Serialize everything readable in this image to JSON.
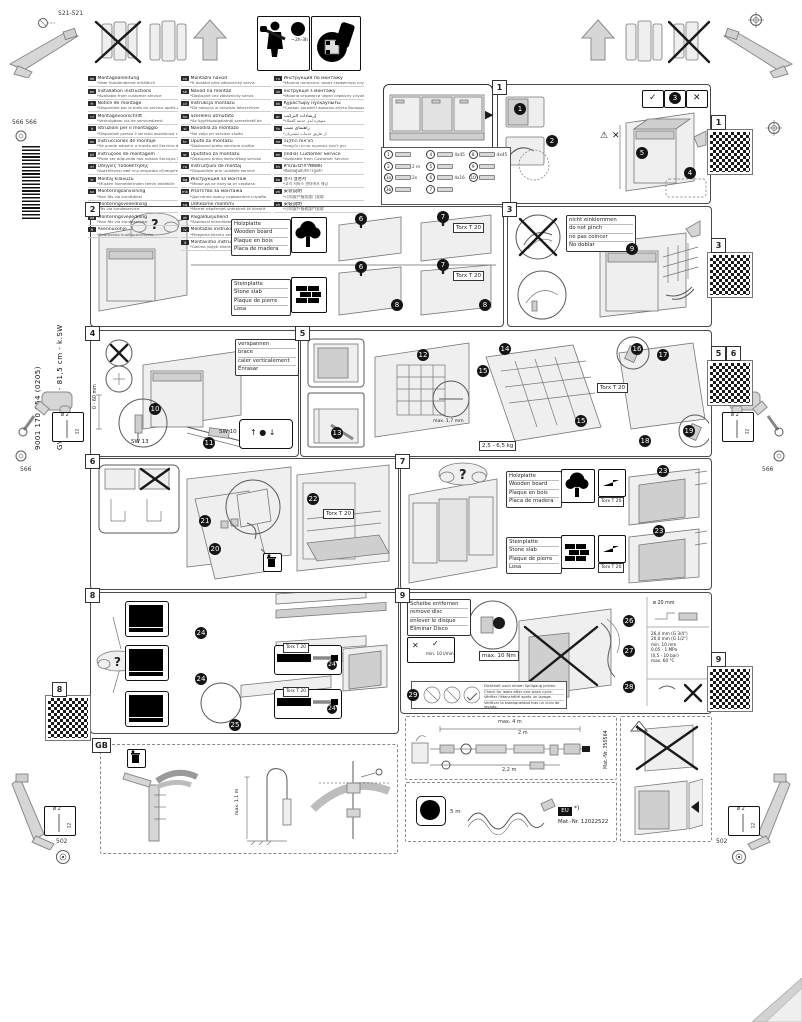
{
  "sidebar": {
    "doc_number": "9001 170 054 (0205)",
    "model": "GV 640 B Vol-I - 81,5 cm - k.SW"
  },
  "header": {
    "time": "~2h-3h"
  },
  "icons": {
    "check": "✓",
    "cross": "✕",
    "question": "?",
    "warning": "⚠",
    "arrow_right": "▶",
    "arrow_left": "◀",
    "balance": "↑ ● ↓"
  },
  "corner": {
    "dim_top_left": "521-521",
    "dim_left": "566 566",
    "dim_side": "566",
    "dim_bottom": "502",
    "drill_dia": "ø 2",
    "drill_depth": "12"
  },
  "panel_numbers": {
    "p1": "1",
    "p2": "2",
    "p3": "3",
    "p4": "4",
    "p5": "5",
    "p6": "6",
    "p7": "7",
    "p8": "8",
    "p9": "9",
    "gb": "GB"
  },
  "qr": {
    "q1": "1",
    "q3": "3",
    "q5": "5",
    "q6": "6",
    "q8": "8",
    "q9": "9"
  },
  "steps": {
    "n1": "1",
    "n2": "2",
    "n3": "3",
    "n4": "4",
    "n5": "5",
    "n6": "6",
    "n7": "7",
    "n8": "8",
    "n9": "9",
    "n10": "10",
    "n11": "11",
    "n12": "12",
    "n13": "13",
    "n14": "14",
    "n15": "15",
    "n16": "16",
    "n17": "17",
    "n18": "18",
    "n19": "19",
    "n20": "20",
    "n21": "21",
    "n22": "22",
    "n23": "23",
    "n24": "24",
    "n25": "25",
    "n26": "26",
    "n27": "27",
    "n28": "28",
    "n29": "29"
  },
  "labels": {
    "wood": [
      "Holzplatte",
      "Wooden board",
      "Plaque en bois",
      "Placa de madera"
    ],
    "stone": [
      "Steinplatte",
      "Stone slab",
      "Plaque de pierre",
      "Losa"
    ],
    "pinch": [
      "nicht einklemmen",
      "do not pinch",
      "ne pas coincer",
      "No doblar"
    ],
    "brace": [
      "verspannen",
      "brace",
      "caler verticalement",
      "Enrasar"
    ],
    "disc": [
      "Scheibe entfernen",
      "remove disc",
      "enlever le disque",
      "Eliminar Disco"
    ],
    "leak": [
      "Dichtheit nach einem Spülgang prüfen.",
      "Check for leaks after one wash cycle.",
      "Vérifier l'étanchéité après un lavage.",
      "Verificar la estanqueidad tras un ciclo de lavado."
    ],
    "torx": "Torx T 20",
    "sw13": "SW 13",
    "sw10": "SW 10",
    "feet_range": "0 - 60 mm",
    "gap": "max. 1,7 mm",
    "panel_weight": "2,5 - 6,5 kg",
    "torque": "max. 10 Nm",
    "flow": "min. 10 l/min",
    "drain_dia": "ø 20 mm",
    "thread1": "26,4 mm (G 3/4\")",
    "thread2": "20,0 mm (G 1/2\")",
    "clearance": "min. 10 mm",
    "pressure1": "0,05 - 1 MPa",
    "pressure2": "(0,5 - 10 bar)",
    "temp": "max. 60 °C",
    "standpipe": "max. 1,1 m",
    "hose_total": "max. 4 m",
    "hose_a": "2 m",
    "hose_b": "2,2 m",
    "hose_part": "Mat.-Nr. 350564",
    "cord_len": "5 m",
    "region": "EU",
    "asterisk": "*)",
    "cord_part": "Mat.-Nr. 12022522"
  },
  "parts": [
    {
      "no": "1",
      "label": ""
    },
    {
      "no": "2",
      "label": "2 m"
    },
    {
      "no": "3a",
      "label": "2x"
    },
    {
      "no": "3b",
      "label": ""
    },
    {
      "no": "4",
      "label": "4x45"
    },
    {
      "no": "5",
      "label": ""
    },
    {
      "no": "6",
      "label": "4x16"
    },
    {
      "no": "7",
      "label": ""
    },
    {
      "no": "8",
      "label": "4x45"
    },
    {
      "no": "9",
      "label": ""
    },
    {
      "no": "10",
      "label": ""
    }
  ],
  "languages": {
    "col1": [
      {
        "c": "de",
        "t": "Montageanleitung",
        "n": "*über Kundendienst erhältlich"
      },
      {
        "c": "en",
        "t": "Installation instructions",
        "n": "*Available from customer service"
      },
      {
        "c": "fr",
        "t": "Notice de montage",
        "n": "*Disponible par le biais du service après-vente"
      },
      {
        "c": "nl",
        "t": "Montagevoorschrift",
        "n": "*Verkrijgbaar via de servicedienst"
      },
      {
        "c": "it",
        "t": "Istruzioni per il montaggio",
        "n": "*Disponibili presso il servizio assistenza clienti"
      },
      {
        "c": "es",
        "t": "Instrucciones de montaje",
        "n": "*Se puede adquirir a través del Servicio de Asistencia Técnica Oficial de la marca"
      },
      {
        "c": "pt",
        "t": "Instruções de montagem",
        "n": "*Pode ser adquirido nos nossos Serviços Técnicos"
      },
      {
        "c": "el",
        "t": "Οδηγίες τοποθέτησης",
        "n": "*Διατίθενται από την υπηρεσία εξυπηρέτησης πελατών"
      },
      {
        "c": "tr",
        "t": "Montaj kılavuzu",
        "n": "*Müşteri hizmetlerinden temin edilebilir"
      },
      {
        "c": "sv",
        "t": "Monteringsanvisning",
        "n": "*Kan fås via kundtjänst"
      },
      {
        "c": "no",
        "t": "Monteringsveiledning",
        "n": "*Fås via kundeservice"
      },
      {
        "c": "da",
        "t": "Monteringsvejledning",
        "n": "*Kan fås via kundeservice"
      },
      {
        "c": "fi",
        "t": "Asennusohje",
        "n": "*Saatavana huoltopalvelusta"
      }
    ],
    "col2": [
      {
        "c": "cs",
        "t": "Montážní návod",
        "n": "*K dostání přes zákaznický servis"
      },
      {
        "c": "sk",
        "t": "Návod na montáž",
        "n": "*Dostupné cez zákaznícky servis"
      },
      {
        "c": "pl",
        "t": "Instrukcja montażu",
        "n": "*Do nabycia w serwisie fabrycznym"
      },
      {
        "c": "hu",
        "t": "Szerelési útmutató",
        "n": "*Az ügyfélszolgálatnál szerezhető be"
      },
      {
        "c": "sl",
        "t": "Navodila za montažo",
        "n": "*Na voljo pri servisni službi"
      },
      {
        "c": "hr",
        "t": "Upute za montažu",
        "n": "*Dostupno preko servisne službe"
      },
      {
        "c": "sr",
        "t": "Uputstvo za montažu",
        "n": "*Dostupno preko korisničkog servisa"
      },
      {
        "c": "ro",
        "t": "Instrucţiuni de montaj",
        "n": "*Disponibile prin unităţile service"
      },
      {
        "c": "bg",
        "t": "Инструкция за монтаж",
        "n": "*Може да се получи от сервиза"
      },
      {
        "c": "mk",
        "t": "Упатство за монтажа",
        "n": "*Достапно преку сервисната служба"
      },
      {
        "c": "sq",
        "t": "Udhëzime montimi",
        "n": "*Merret nëpërmjet shërbimit të klientit"
      },
      {
        "c": "et",
        "t": "Paigaldusjuhend",
        "n": "*Saadaval klienditeeninduse kaudu"
      },
      {
        "c": "lv",
        "t": "Montāžas instrukcija",
        "n": "*Pieejama klientu servisā"
      },
      {
        "c": "lt",
        "t": "Montavimo instrukcija",
        "n": "*Galima įsigyti klientų aptarnavimo tarnyboje"
      }
    ],
    "col3": [
      {
        "c": "ru",
        "t": "Инструкция по монтажу",
        "n": "*Можно получить через сервисную службу"
      },
      {
        "c": "uk",
        "t": "Інструкція з монтажу",
        "n": "*Можна отримати через сервісну службу"
      },
      {
        "c": "kk",
        "t": "Құрастыру нұсқаулығы",
        "n": "*Сервис қызметі арқылы алуға болады"
      },
      {
        "c": "ar",
        "t": "إرشادات التركيب",
        "n": "*متوفرة لدى خدمة العملاء"
      },
      {
        "c": "fa",
        "t": "راهنمای نصب",
        "n": "*از طریق خدمات مشتریان"
      },
      {
        "c": "he",
        "t": "הוראות התקנה",
        "n": "*ניתן להשיג באמצעות שירות הלקוחות"
      },
      {
        "c": "en",
        "t": "(India) Customer Service",
        "n": "*Available from Customer Service"
      },
      {
        "c": "th",
        "t": "คำแนะนำการติดตั้ง",
        "n": "*ติดต่อศูนย์บริการลูกค้า"
      },
      {
        "c": "ko",
        "t": "설치 설명서",
        "n": "*고객 서비스 센터에서 제공"
      },
      {
        "c": "zh",
        "t": "安装说明",
        "n": "*可向客户服务部门索取"
      },
      {
        "c": "zh",
        "t": "安裝說明",
        "n": "*可向客戶服務部門索取"
      }
    ]
  }
}
